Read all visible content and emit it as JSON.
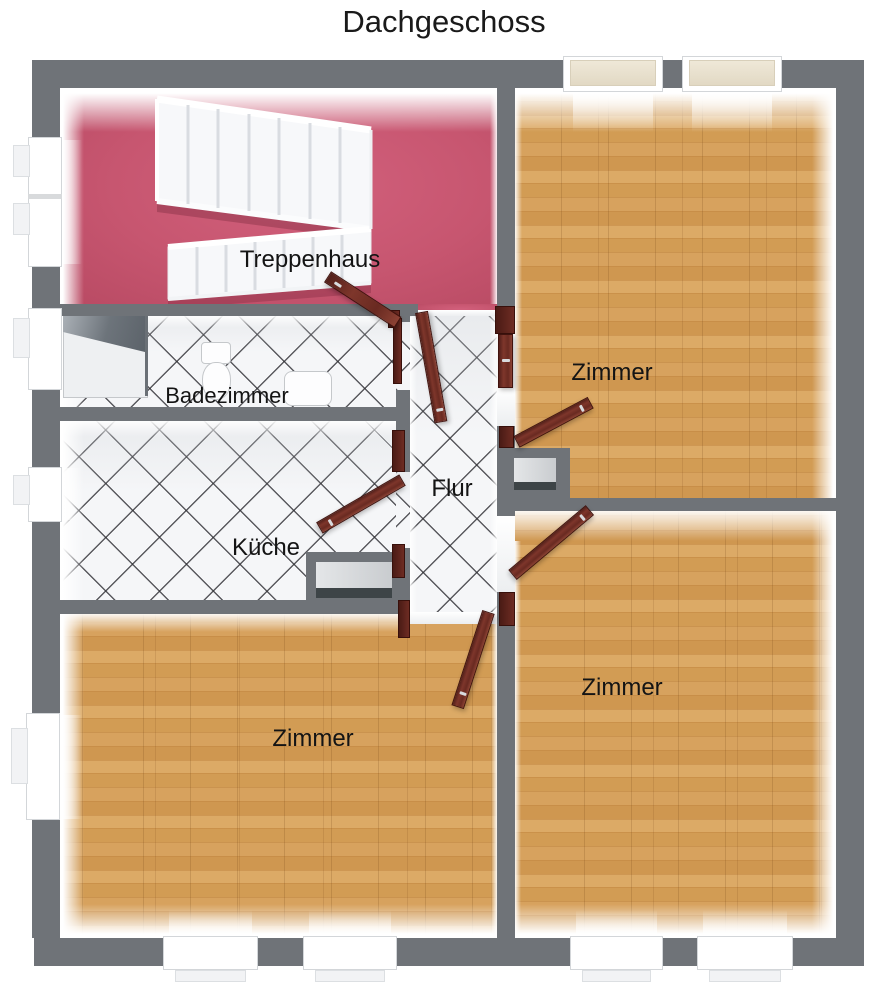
{
  "title": "Dachgeschoss",
  "rooms": {
    "treppenhaus": {
      "label": "Treppenhaus",
      "floor": "pink"
    },
    "zimmer_top_right": {
      "label": "Zimmer",
      "floor": "wood"
    },
    "badezimmer": {
      "label": "Badezimmer",
      "floor": "tile"
    },
    "flur": {
      "label": "Flur",
      "floor": "tile"
    },
    "kueche": {
      "label": "Küche",
      "floor": "tile"
    },
    "zimmer_bottom_left": {
      "label": "Zimmer",
      "floor": "wood"
    },
    "zimmer_bottom_right": {
      "label": "Zimmer",
      "floor": "wood"
    }
  },
  "colors": {
    "wall_gray": "#6f7378",
    "treppenhaus_floor_pink": "#c75670",
    "wood_floor": "#d09a55",
    "tile_floor": "#f5f6f8",
    "tile_line": "#3e3e42",
    "door_brown": "#6b2a22",
    "skylight_beige": "#e9e1cf",
    "stairs_white": "#f7f8fa"
  }
}
